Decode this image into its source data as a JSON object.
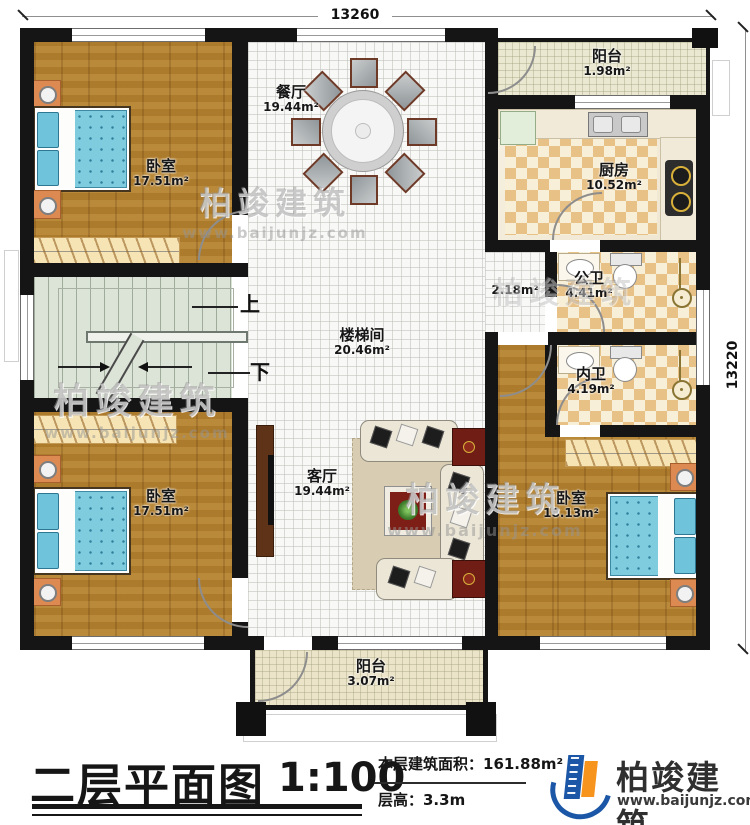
{
  "dimensions": {
    "top": "13260",
    "right": "13220"
  },
  "rooms": {
    "bedroom_tl": {
      "name": "卧室",
      "area": "17.51m²"
    },
    "dining": {
      "name": "餐厅",
      "area": "19.44m²"
    },
    "balcony_top": {
      "name": "阳台",
      "area": "1.98m²"
    },
    "kitchen": {
      "name": "厨房",
      "area": "10.52m²"
    },
    "public_bath": {
      "name": "公卫",
      "area": "4.41m²"
    },
    "hall_corner": {
      "area": "2.18m²"
    },
    "private_bath": {
      "name": "内卫",
      "area": "4.19m²"
    },
    "stairwell": {
      "name": "楼梯间",
      "area": "20.46m²"
    },
    "living": {
      "name": "客厅",
      "area": "19.44m²"
    },
    "bedroom_bl": {
      "name": "卧室",
      "area": "17.51m²"
    },
    "bedroom_br": {
      "name": "卧室",
      "area": "18.13m²"
    },
    "balcony_bottom": {
      "name": "阳台",
      "area": "3.07m²"
    }
  },
  "stairs": {
    "up": "上",
    "down": "下"
  },
  "watermark": {
    "brand": "柏竣建筑",
    "site": "www.baijunjz.com"
  },
  "titleblock": {
    "title": "二层平面图",
    "scale": "1:100",
    "floor_area": "本层建筑面积：161.88m²",
    "floor_height": "层高：3.3m",
    "brand": "柏竣建筑",
    "website": "www.baijunjz.com"
  },
  "colors": {
    "wall": "#151515",
    "wood": "#b2802e",
    "bath_tile": "#e7c186",
    "brand_blue": "#1b57a6",
    "brand_orange": "#f7941d"
  }
}
